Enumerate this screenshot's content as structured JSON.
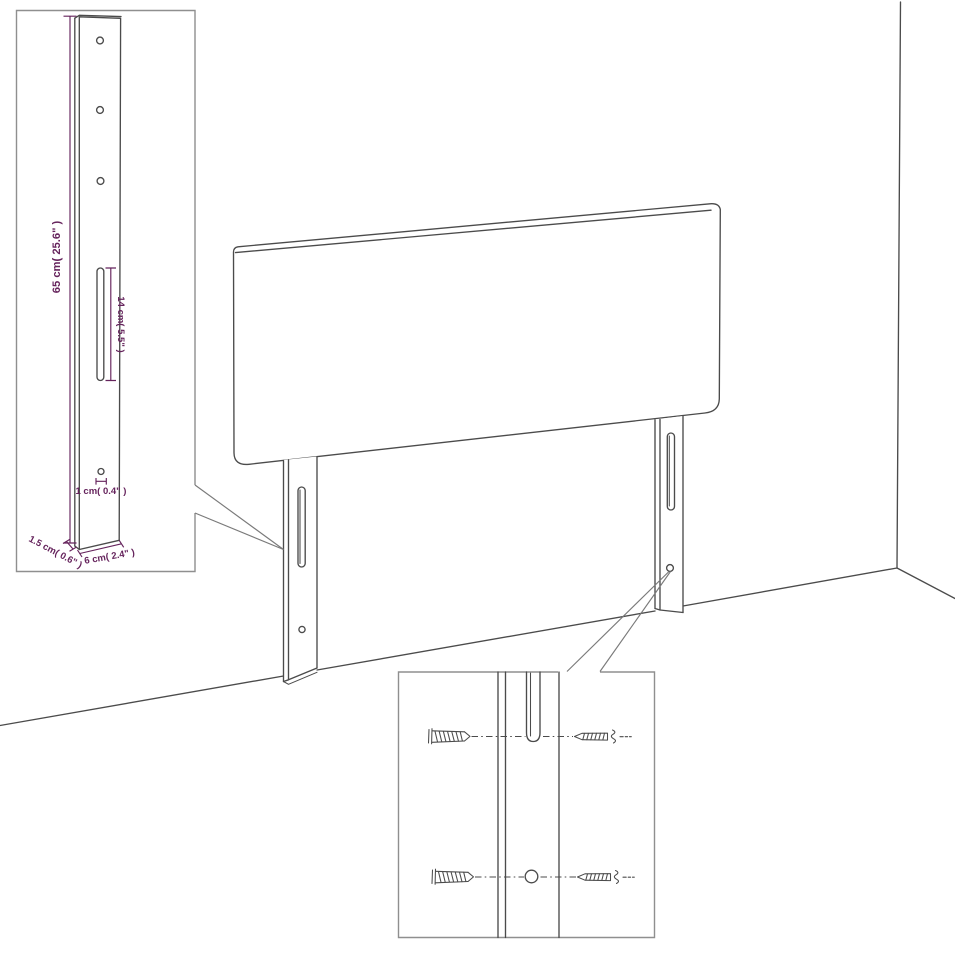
{
  "colors": {
    "background": "#ffffff",
    "line": "#4b4b4b",
    "inset_border": "#8f8f8f",
    "dimension_text": "#65235c"
  },
  "dims": {
    "height": "65 cm( 25.6\" )",
    "slot": "14 cm( 5.5\" )",
    "hole": "1 cm( 0.4\" )",
    "thickness": "1.5 cm( 0.6\" )",
    "width": "6 cm( 2.4\" )"
  },
  "details": {
    "leg_top_hole_count": 3,
    "hardware_icons": [
      "wall-plug-icon",
      "screw-icon"
    ]
  }
}
